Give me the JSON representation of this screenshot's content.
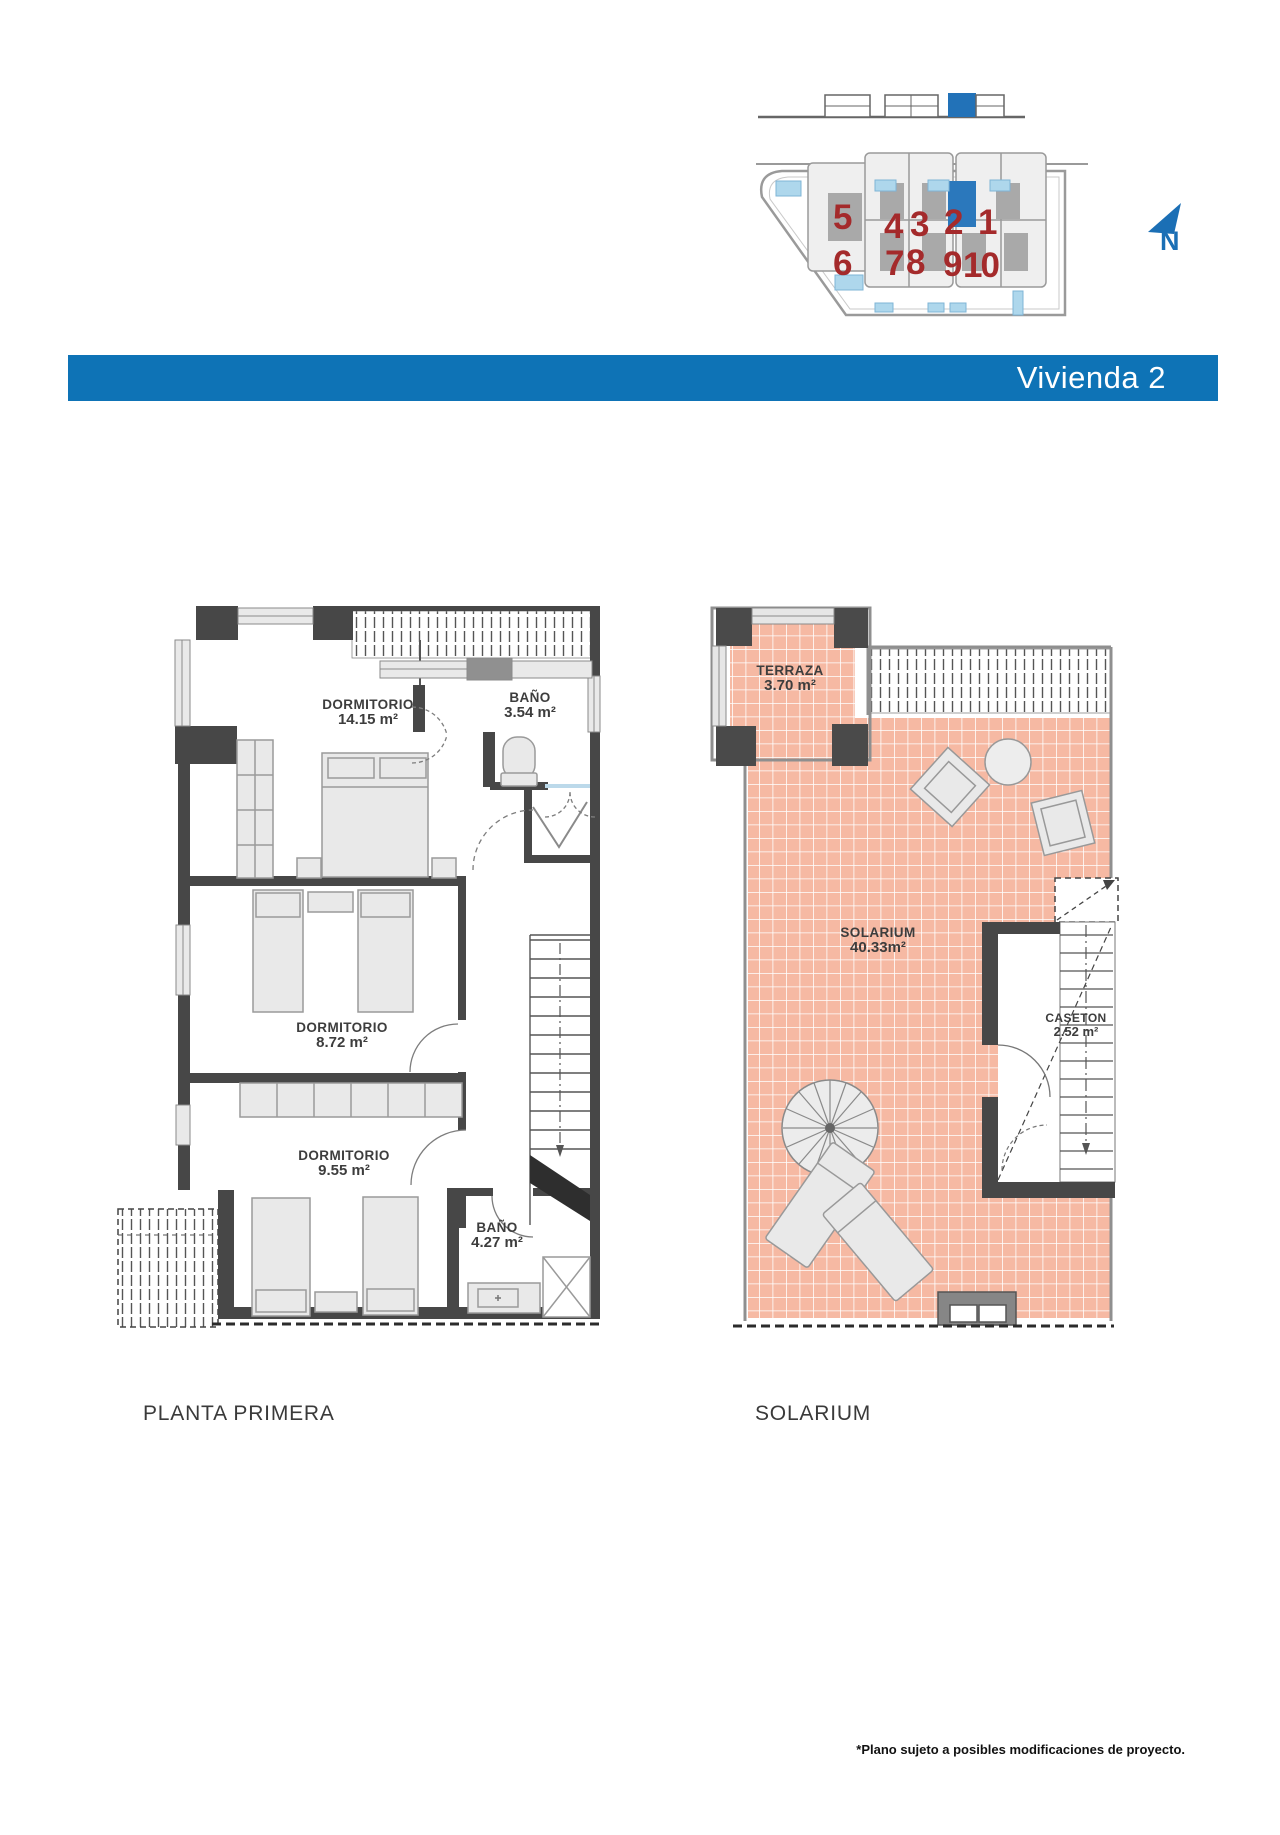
{
  "site": {
    "north_label": "N",
    "row1": [
      "5",
      "4",
      "3",
      "2",
      "1"
    ],
    "row2": [
      "6",
      "7",
      "8",
      "9",
      "10"
    ],
    "highlight_unit": "2",
    "number_color": "#a42a2b",
    "highlight_color": "#2b78bc"
  },
  "header": {
    "title": "Vivienda 2",
    "bar_color": "#0e73b6"
  },
  "plans": {
    "left": {
      "caption": "PLANTA PRIMERA",
      "rooms": {
        "dorm1": {
          "name": "DORMITORIO",
          "area": "14.15 m²"
        },
        "bano1": {
          "name": "BAÑO",
          "area": "3.54 m²"
        },
        "dorm2": {
          "name": "DORMITORIO",
          "area": "8.72 m²"
        },
        "dorm3": {
          "name": "DORMITORIO",
          "area": "9.55 m²"
        },
        "bano2": {
          "name": "BAÑO",
          "area": "4.27 m²"
        }
      }
    },
    "right": {
      "caption": "SOLARIUM",
      "rooms": {
        "terraza": {
          "name": "TERRAZA",
          "area": "3.70 m²"
        },
        "solarium": {
          "name": "SOLARIUM",
          "area": "40.33m²"
        },
        "caseton": {
          "name": "CASETON",
          "area": "2.52 m²"
        }
      }
    }
  },
  "footer": {
    "note": "*Plano sujeto a posibles modificaciones de proyecto."
  }
}
